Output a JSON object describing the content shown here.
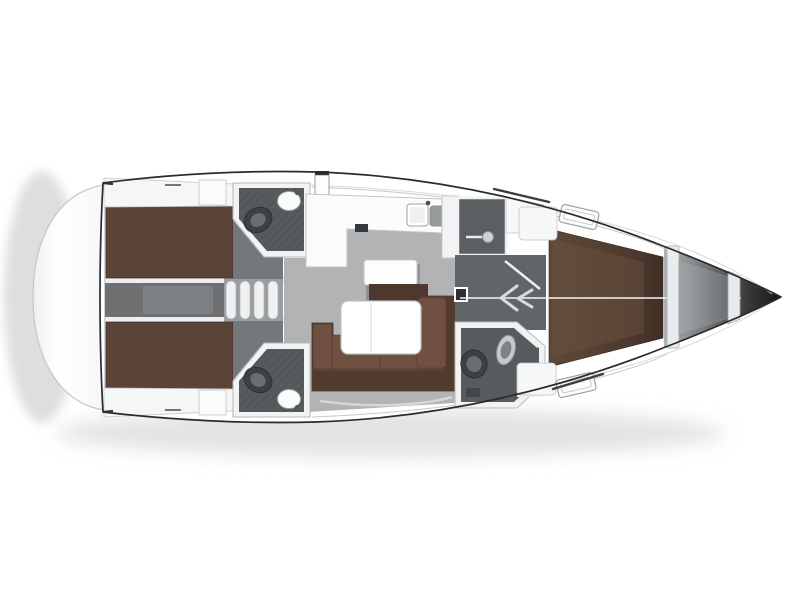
{
  "meta": {
    "description": "Top-down interior layout plan of a sailing yacht, bow to the right, no text labels rendered",
    "canvas": {
      "width": 800,
      "height": 600
    }
  },
  "colors": {
    "background": "#ffffff",
    "hull_outline": "#2b2b2b",
    "wall": "#f2f3f4",
    "wall_stroke": "#b5b8b9",
    "platform": "#fbfcfc",
    "shadow": "#e2e3e4",
    "berth_brown": "#5a4337",
    "berth_dark": "#3f2e25",
    "vberth_light": "#68513f",
    "sofa_base": "#5d4235",
    "sofa_cushion": "#6f5041",
    "sofa_back": "#533a2e",
    "island_front": "#4e382d",
    "salon_floor": "#b1b3b4",
    "corridor": "#6e7072",
    "corridor_light": "#7e8183",
    "cabin_floor": "#75787a",
    "head_floor": "#575b5d",
    "shower": "#5b5f61",
    "wardrobe": "#626567",
    "fixture_dark": "#3e4143",
    "fixture_mid": "#6b6e70",
    "sink": "#fbfcfc",
    "sink_gray": "#989b9c",
    "counter": "#fafbfb",
    "steps": "#f0f1f2",
    "steps_bg": "#9b9ea0",
    "anchor_locker": "#8f9294",
    "bow_tip": "#161616",
    "seam": "#f4f5f5",
    "track": "#3c3c3c",
    "hatch": "#fbfcfc"
  },
  "regions": [
    "swim-platform",
    "transom",
    "aft-cabin-port",
    "aft-cabin-starboard",
    "engine-compartment",
    "companionway-steps",
    "aft-head-port",
    "aft-head-starboard",
    "saloon",
    "galley",
    "galley-island",
    "saloon-table",
    "saloon-sofa",
    "shower-room",
    "wardrobe",
    "forward-head",
    "forward-cabin",
    "anchor-locker",
    "bow"
  ],
  "icons": [
    "toilet-icon",
    "sink-icon",
    "shower-head-icon",
    "wardrobe-chevron-icon",
    "companionway-steps-icon",
    "deck-hatch-icon"
  ]
}
